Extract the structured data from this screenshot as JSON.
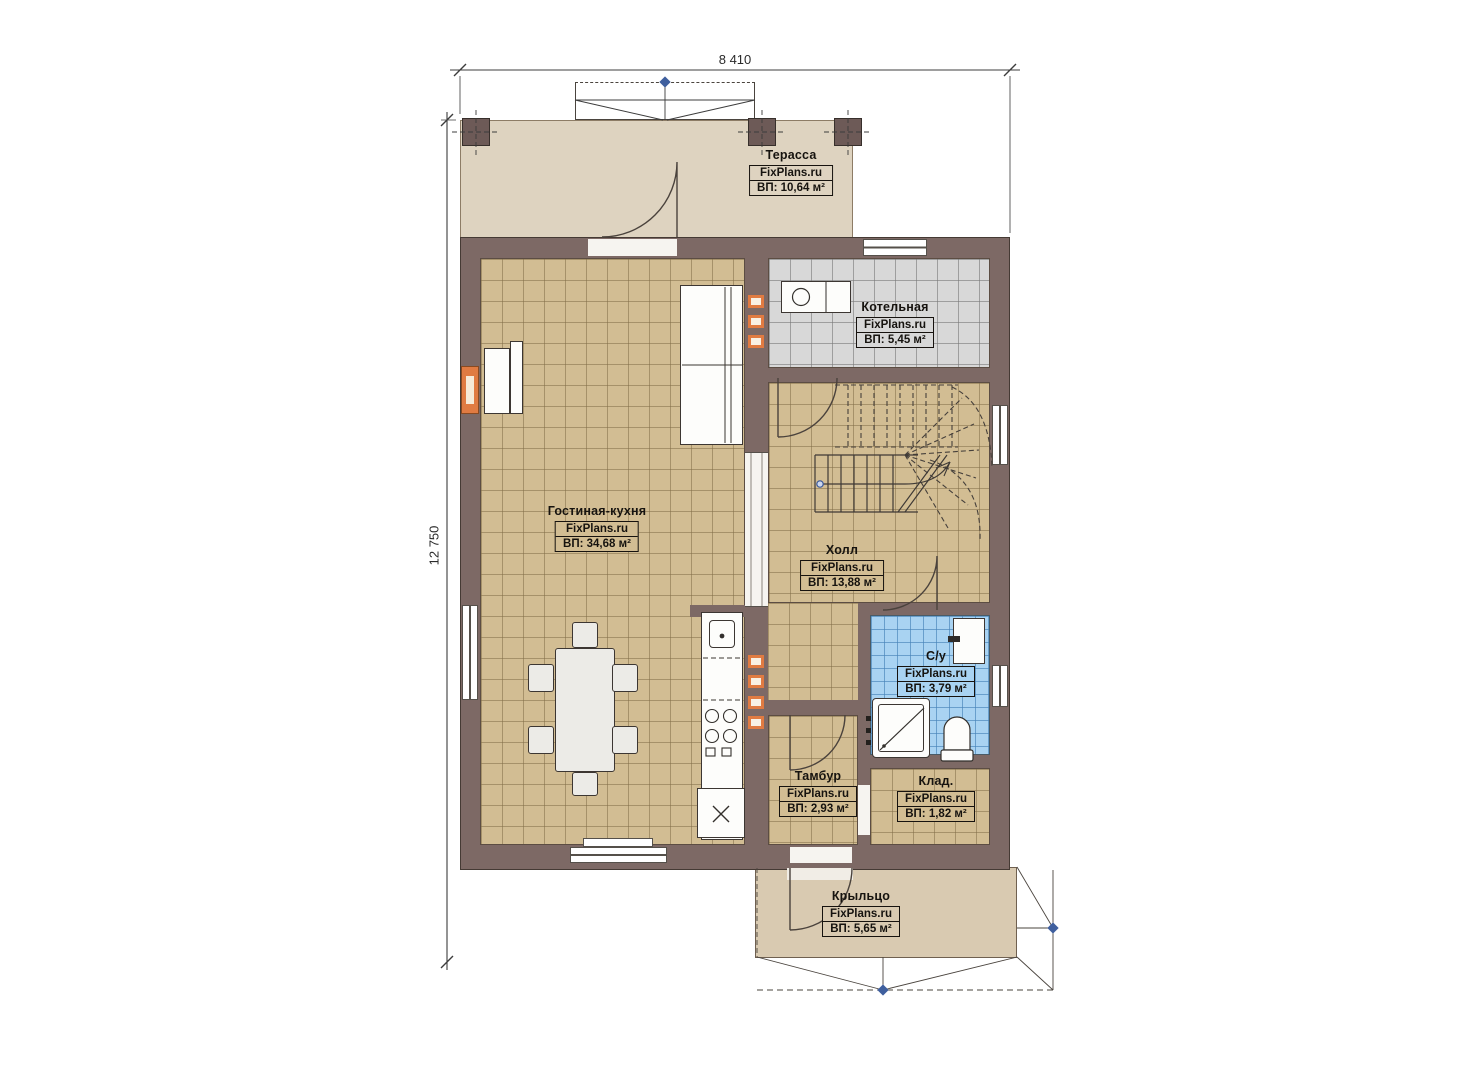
{
  "plan": {
    "brand": "FixPlans.ru",
    "dimensions": {
      "width": "8 410",
      "height": "12 750"
    },
    "rooms": [
      {
        "id": "terrace",
        "name": "Терасса",
        "area": "ВП: 10,64 м²"
      },
      {
        "id": "boiler",
        "name": "Котельная",
        "area": "ВП: 5,45 м²"
      },
      {
        "id": "living-kitchen",
        "name": "Гостиная-кухня",
        "area": "ВП: 34,68 м²"
      },
      {
        "id": "hall",
        "name": "Холл",
        "area": "ВП: 13,88 м²"
      },
      {
        "id": "bathroom",
        "name": "С/у",
        "area": "ВП: 3,79 м²"
      },
      {
        "id": "vestibule",
        "name": "Тамбур",
        "area": "ВП: 2,93 м²"
      },
      {
        "id": "storage",
        "name": "Клад.",
        "area": "ВП: 1,82 м²"
      },
      {
        "id": "porch",
        "name": "Крыльцо",
        "area": "ВП: 5,65 м²"
      }
    ],
    "colors": {
      "wall": "#7d6965",
      "floor_tan": "#d2bd93",
      "floor_gray": "#d8d8d8",
      "floor_blue": "#a9d3f2",
      "terrace": "#ded3c0",
      "porch": "#d9cab1",
      "accent_orange": "#e07b42"
    }
  }
}
